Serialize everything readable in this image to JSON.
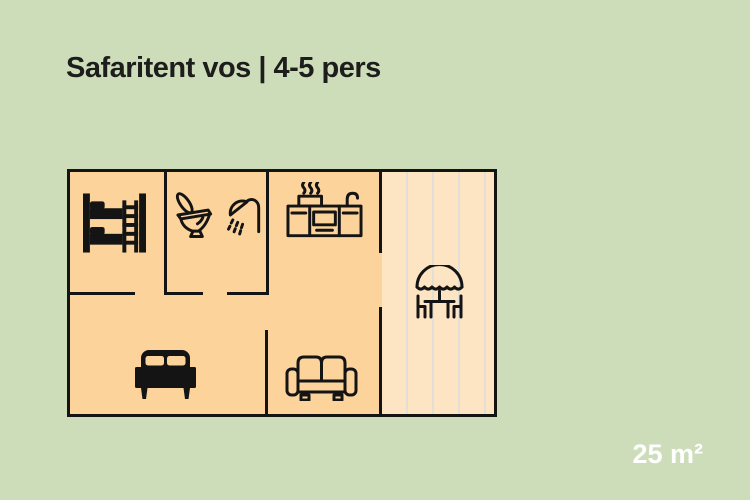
{
  "title": "Safaritent vos | 4-5 pers",
  "area_label": "25 m²",
  "colors": {
    "background": "#cdddba",
    "plan_fill": "#fbd39b",
    "deck_fill": "#fde4c2",
    "deck_stripe": "#e3dfd7",
    "wall": "#141414",
    "title_text": "#1d1d1b",
    "area_text": "#ffffff"
  },
  "floor_plan": {
    "rooms": [
      {
        "name": "bunk-room",
        "icons": [
          "bunk-bed-icon"
        ]
      },
      {
        "name": "bathroom",
        "icons": [
          "toilet-icon",
          "shower-icon"
        ]
      },
      {
        "name": "kitchen-living-room",
        "icons": [
          "kitchen-icon",
          "sofa-icon"
        ]
      },
      {
        "name": "bedroom",
        "icons": [
          "double-bed-icon"
        ]
      },
      {
        "name": "veranda-deck",
        "icons": [
          "picnic-table-umbrella-icon"
        ]
      }
    ],
    "icons": {
      "bunk-bed-icon": "solid bunk bed with ladder",
      "toilet-icon": "outline toilet with open lid",
      "shower-icon": "outline shower head with spray",
      "kitchen-icon": "outline kitchen counter with stove pot, steam and faucet",
      "double-bed-icon": "solid double bed with two pillows",
      "sofa-icon": "outline two-seat sofa",
      "picnic-table-umbrella-icon": "outline parasol over table with two chairs"
    }
  }
}
